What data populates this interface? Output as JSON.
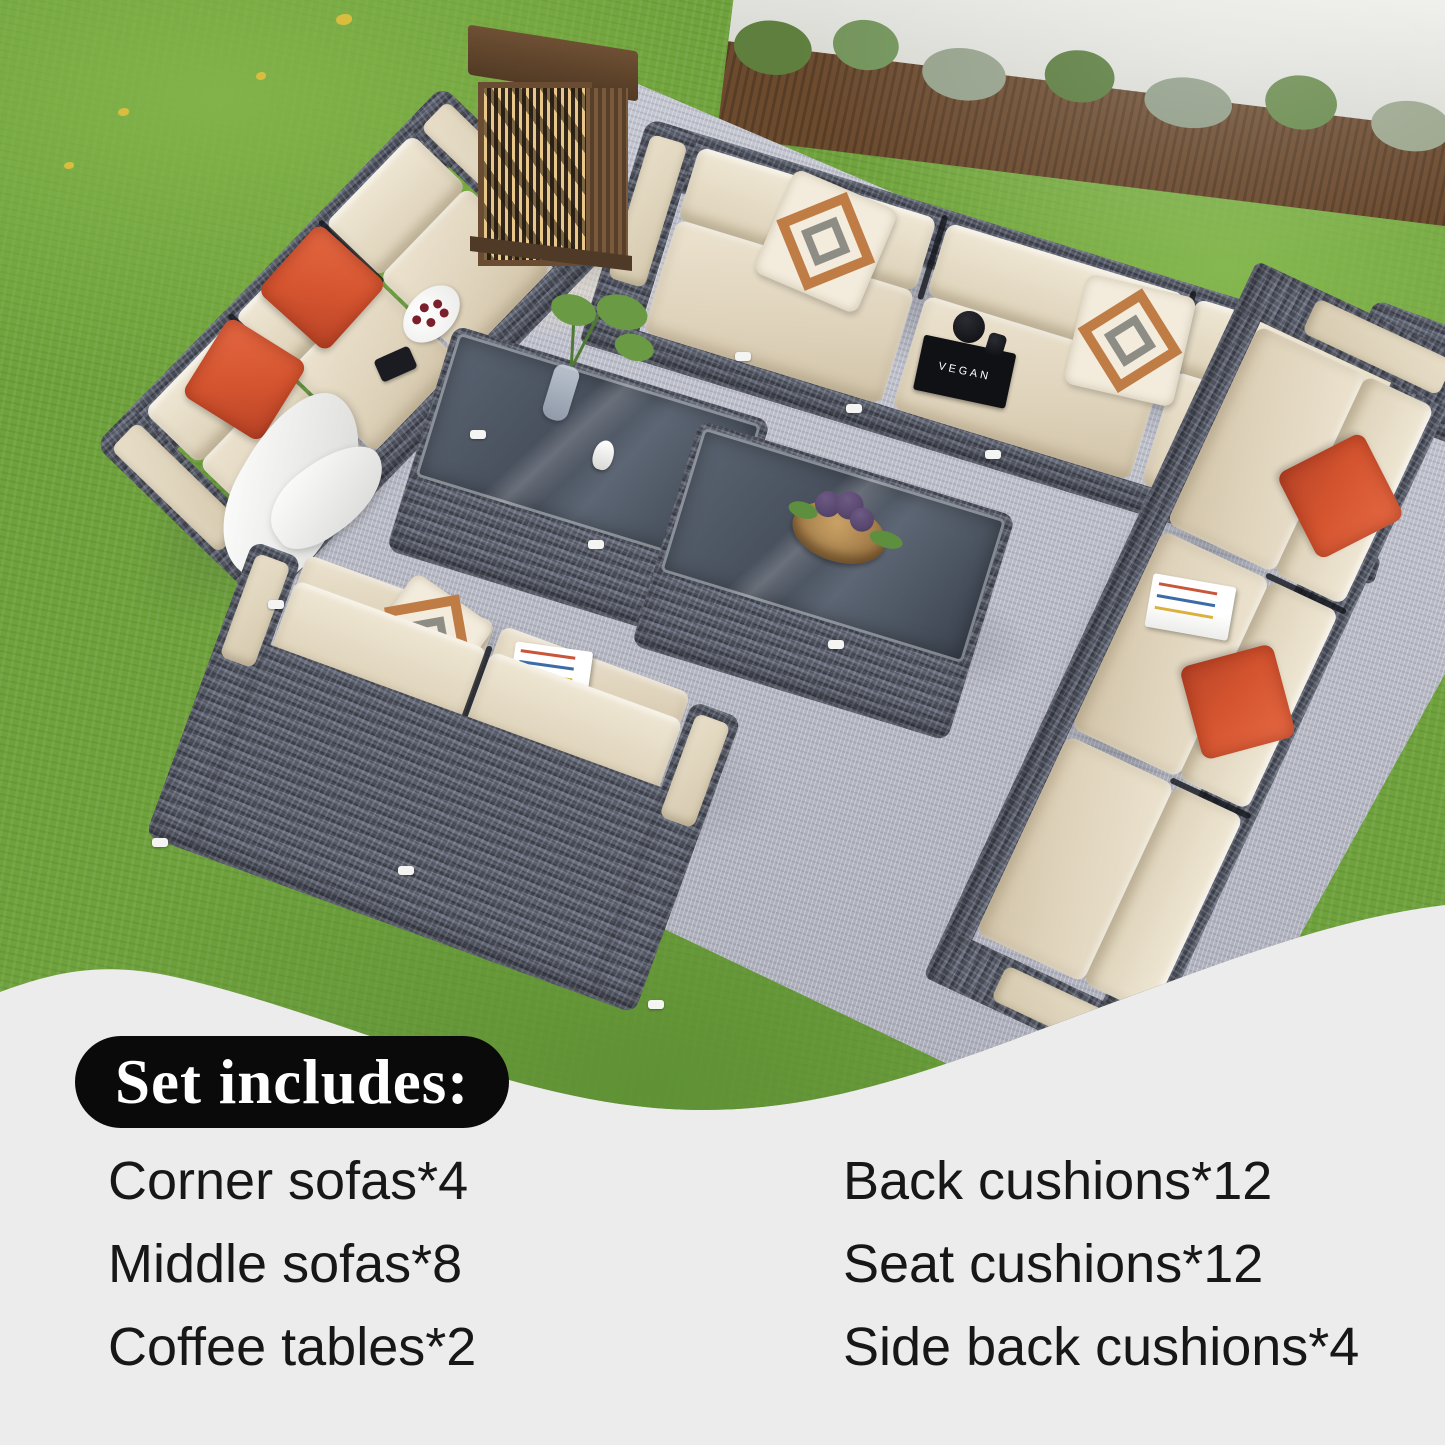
{
  "overlay": {
    "badge_label": "Set includes:",
    "items_left": [
      "Corner sofas*4",
      "Middle sofas*8",
      "Coffee tables*2"
    ],
    "items_right": [
      "Back cushions*12",
      "Seat cushions*12",
      "Side back cushions*4"
    ],
    "badge_bg": "#0a0a0a",
    "badge_text_color": "#ffffff",
    "panel_bg": "#ececec",
    "text_color": "#171717"
  },
  "scene": {
    "book_spine": "VEGAN",
    "colors": {
      "grass": "#6fa23c",
      "rug": "#bdbfca",
      "wicker_dark": "#474b57",
      "wicker_light": "#6b7080",
      "cushion_beige": "#e0d5bf",
      "pillow_orange": "#d4542f",
      "pattern_pillow_accent": "#bf7c45",
      "glass_top": "#4a5361",
      "lantern_bronze": "#6a4c33",
      "lantern_glow": "#e9c788",
      "wall_white": "#e9eae6",
      "mulch_brown": "#6b4a2e"
    }
  }
}
